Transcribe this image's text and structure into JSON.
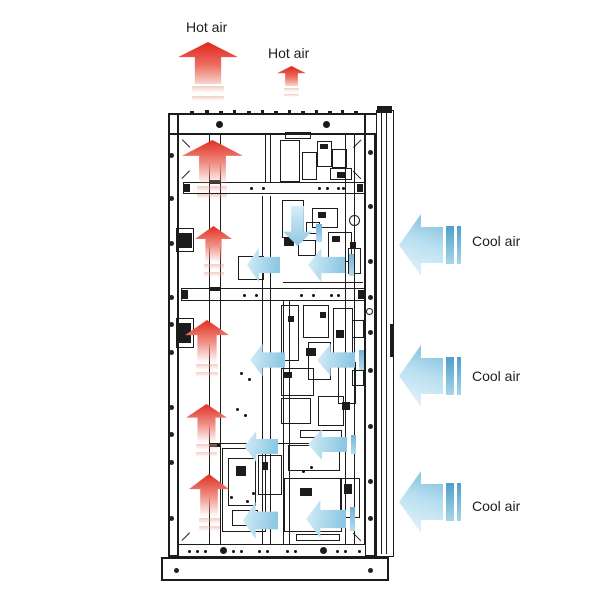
{
  "diagram": {
    "type": "airflow-cooling-diagram",
    "subject": "Equipment cabinet cross-section showing hot air exhaust (up) and cool air intake (from right)"
  },
  "labels": {
    "hot_air_large": "Hot air",
    "hot_air_small": "Hot air",
    "cool_air": [
      "Cool air",
      "Cool air",
      "Cool air"
    ]
  },
  "airflow": {
    "hot_exhaust": {
      "label": "Hot air",
      "direction": "up",
      "external_arrow_count": 2,
      "internal_arrow_count": 5,
      "color": "#e02f22"
    },
    "cool_intake": {
      "label": "Cool air",
      "direction": "left",
      "external_arrow_count": 3,
      "internal_arrow_count": 9,
      "color": "#8fc8e3"
    }
  },
  "colors": {
    "hot": "#e02f22",
    "hot_fade": "#fbded9",
    "cool_dark": "#55a2cc",
    "cool_mid": "#8fc8e3",
    "cool_light": "#e6f4fb",
    "line": "#1c1c1c",
    "background": "#ffffff"
  }
}
